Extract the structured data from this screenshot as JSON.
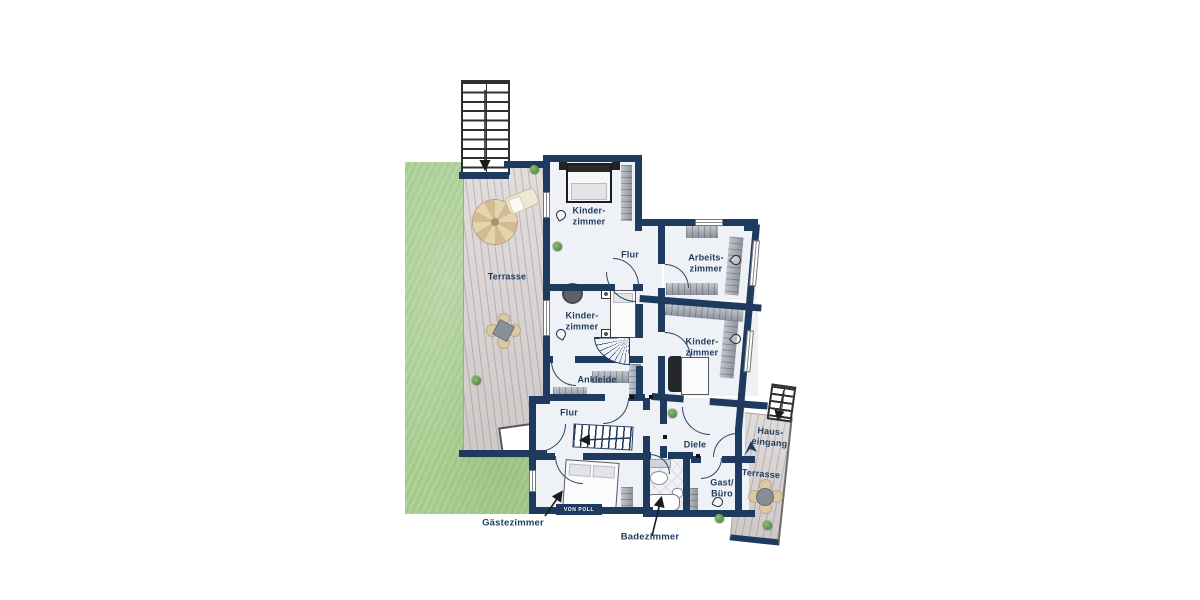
{
  "title": "Floor plan (Grundriss)",
  "colors": {
    "wall": "#1e3a5e",
    "floor": "#eef1f6",
    "garden": "#a9cf92",
    "deck": "#d9d3d2",
    "label": "#1f3a5f",
    "arrow": "#1c1c1c"
  },
  "labels": {
    "terrace_left": "Terrasse",
    "kinder_top": [
      "Kinder-",
      "zimmer"
    ],
    "flur_top": "Flur",
    "arbeitszimmer": [
      "Arbeits-",
      "zimmer"
    ],
    "kinder_mid": [
      "Kinder-",
      "zimmer"
    ],
    "kinder_right": [
      "Kinder-",
      "zimmer"
    ],
    "ankleide": "Ankleide",
    "flur_lower": "Flur",
    "diele": "Diele",
    "gast_buero": [
      "Gast/",
      "Büro"
    ],
    "hauseingang": [
      "Haus-",
      "eingang"
    ],
    "terrace_right": "Terrasse",
    "gaestezimmer": "Gästezimmer",
    "badezimmer": "Badezimmer"
  },
  "watermark": {
    "logo_text": "VON POLL"
  },
  "features": {
    "stairs": [
      "exterior-top-stairs",
      "interior-stairs",
      "spiral-stairs",
      "entrance-stairs"
    ],
    "outdoor": [
      "garden",
      "terrace-left",
      "terrace-right",
      "entrance-walkway"
    ]
  }
}
